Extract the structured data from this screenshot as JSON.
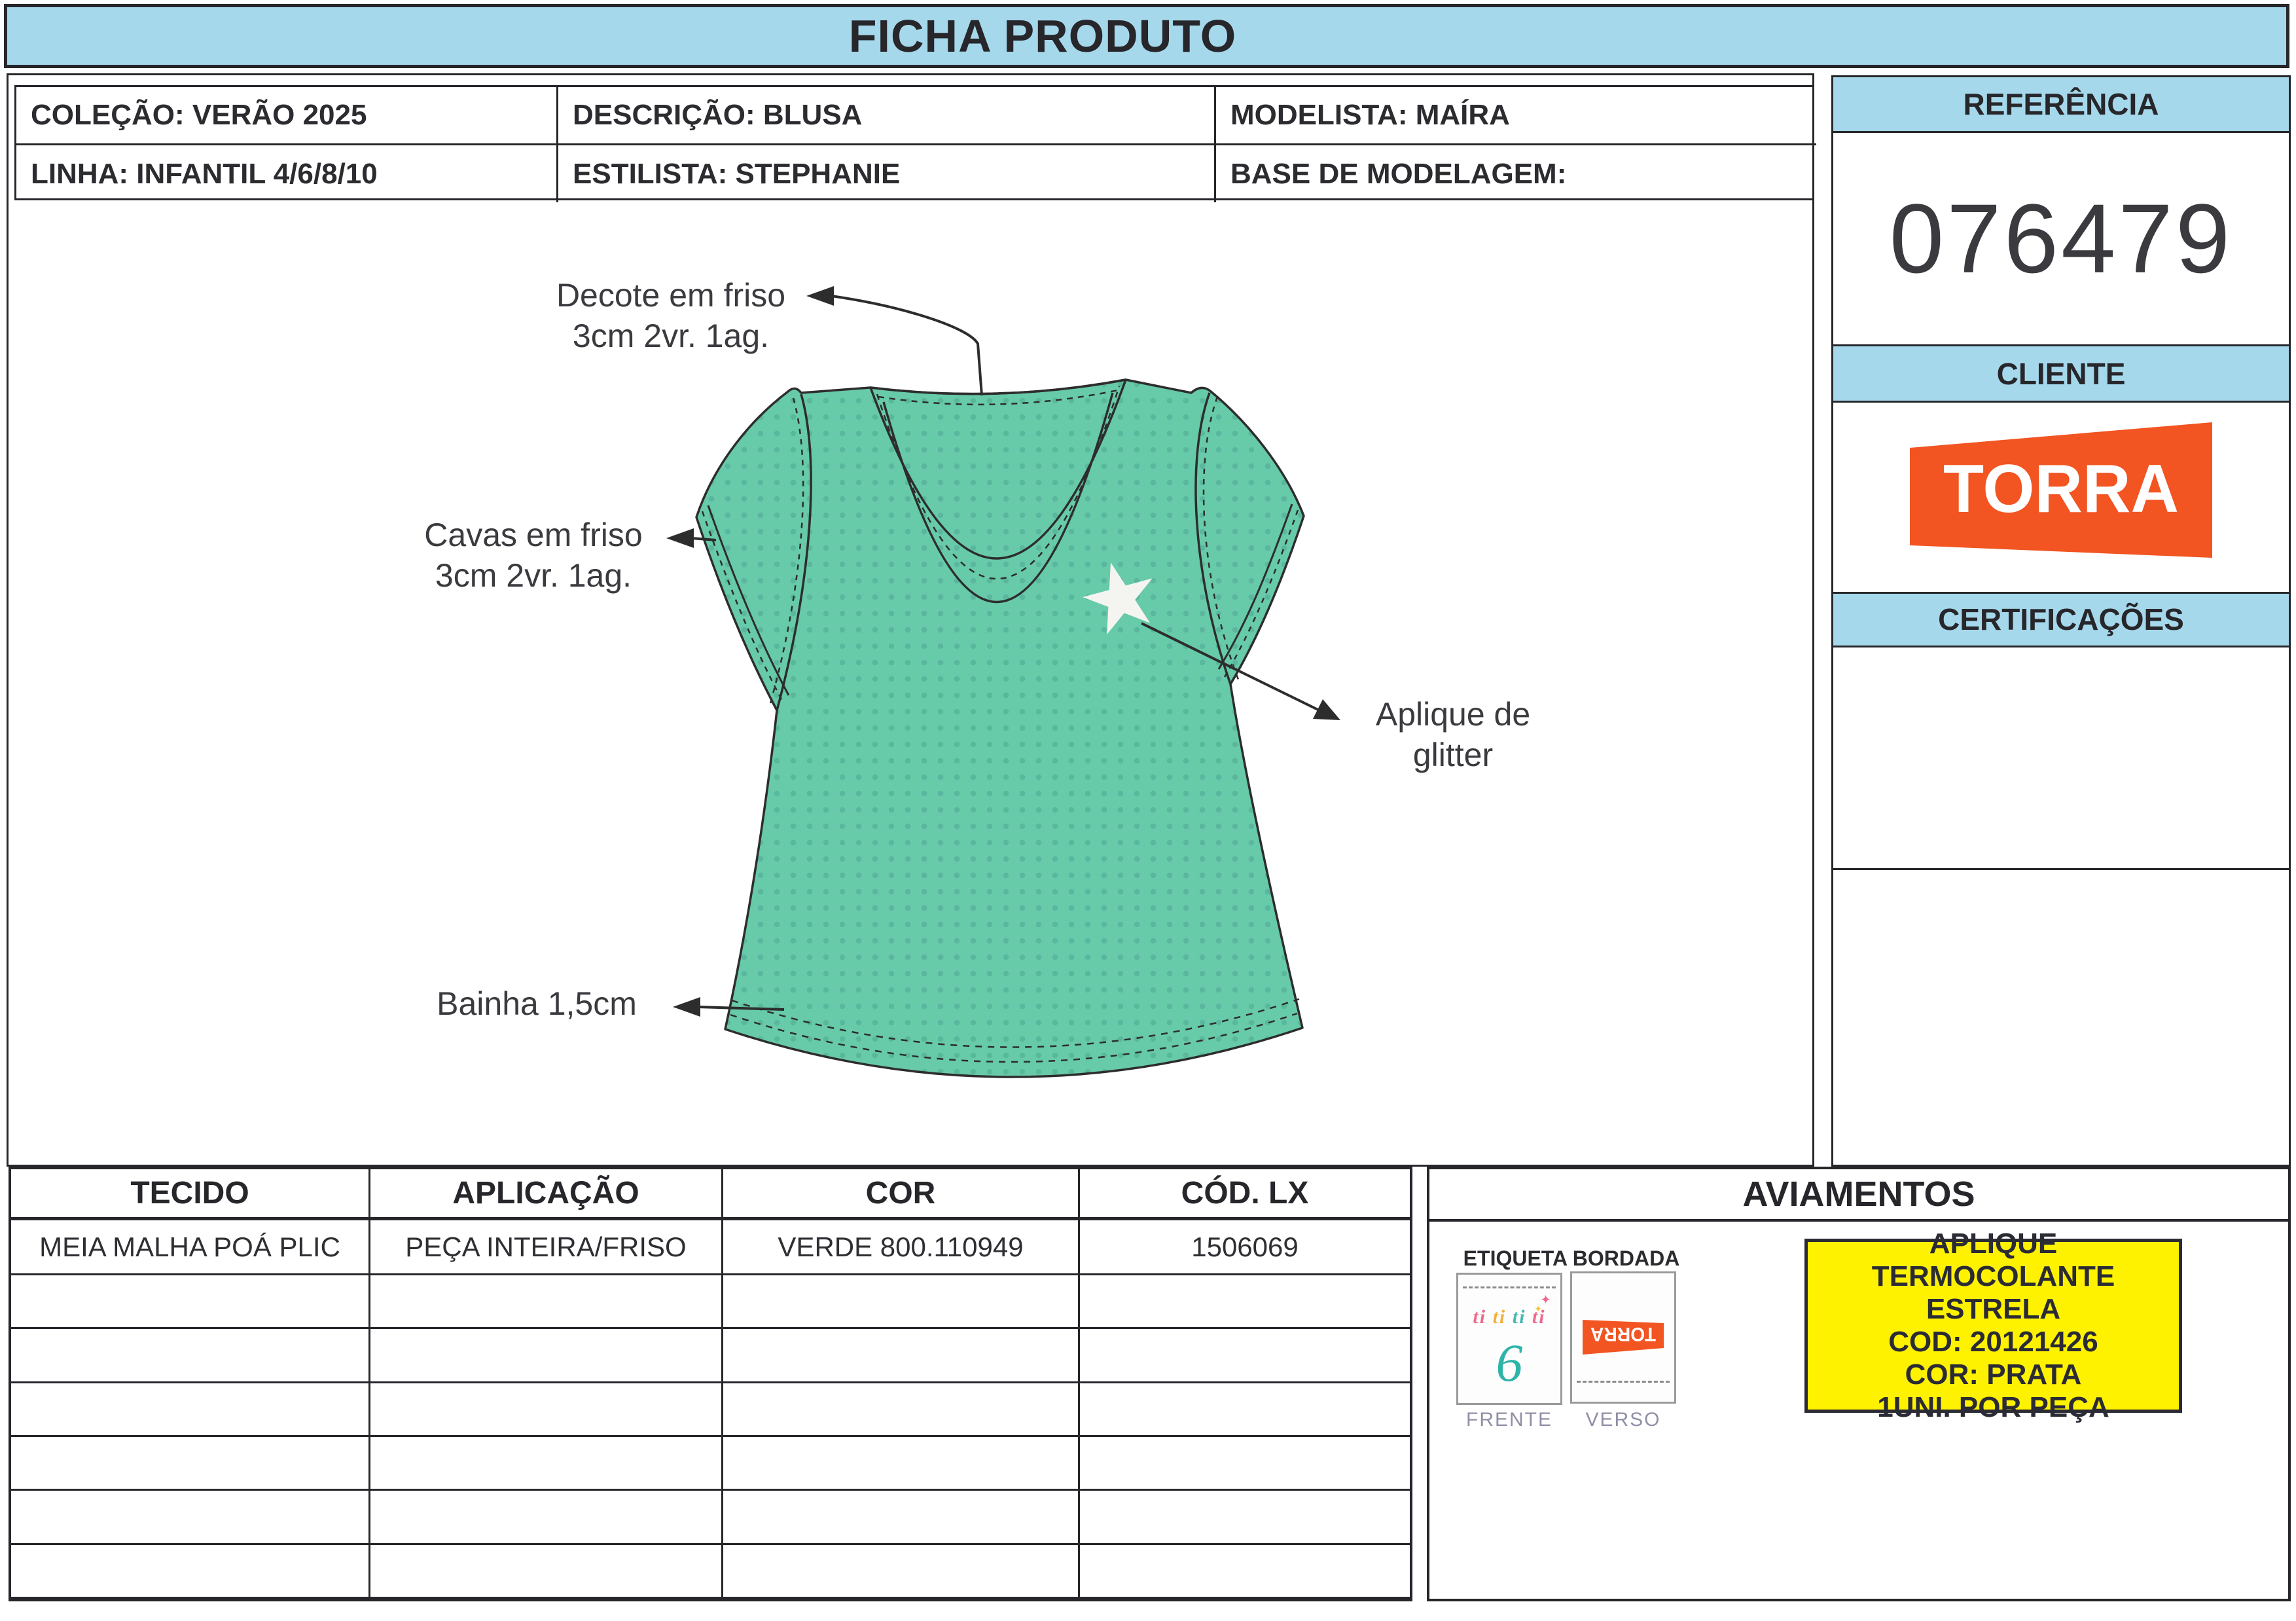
{
  "title": "FICHA PRODUTO",
  "info": {
    "colecao": "COLEÇÃO: VERÃO 2025",
    "descricao": "DESCRIÇÃO: BLUSA",
    "modelista": "MODELISTA: MAÍRA",
    "linha": "LINHA: INFANTIL 4/6/8/10",
    "estilista": "ESTILISTA: STEPHANIE",
    "base_modelagem": "BASE DE MODELAGEM:"
  },
  "sidebar": {
    "referencia_label": "REFERÊNCIA",
    "referencia_value": "076479",
    "cliente_label": "CLIENTE",
    "cliente_logo_text": "TORRA",
    "certificacoes_label": "CERTIFICAÇÕES"
  },
  "annotations": {
    "decote_line1": "Decote em friso",
    "decote_line2": "3cm 2vr. 1ag.",
    "cavas_line1": "Cavas em friso",
    "cavas_line2": "3cm 2vr. 1ag.",
    "bainha": "Bainha 1,5cm",
    "aplique_line1": "Aplique de",
    "aplique_line2": "glitter"
  },
  "table": {
    "headers": [
      "TECIDO",
      "APLICAÇÃO",
      "COR",
      "CÓD. LX"
    ],
    "rows": [
      [
        "MEIA MALHA POÁ PLIC",
        "PEÇA INTEIRA/FRISO",
        "VERDE 800.110949",
        "1506069"
      ],
      [
        "",
        "",
        "",
        ""
      ],
      [
        "",
        "",
        "",
        ""
      ],
      [
        "",
        "",
        "",
        ""
      ],
      [
        "",
        "",
        "",
        ""
      ],
      [
        "",
        "",
        "",
        ""
      ],
      [
        "",
        "",
        "",
        ""
      ]
    ]
  },
  "aviamentos": {
    "title": "AVIAMENTOS",
    "etiqueta_label": "ETIQUETA BORDADA",
    "tag_brand": [
      "ti",
      "ti",
      "ti",
      "ti"
    ],
    "tag_number": "6",
    "tag_logo_text": "TORRA",
    "frente_caption": "FRENTE",
    "verso_caption": "VERSO",
    "yellow_note_lines": [
      "APLIQUE TERMOCOLANTE",
      "ESTRELA",
      "COD: 20121426",
      "COR: PRATA",
      "1UNI. POR PEÇA"
    ]
  },
  "colors": {
    "header_blue": "#a6d8eb",
    "torra_orange": "#f25422",
    "note_yellow": "#fff200",
    "garment_green": "#67caa9",
    "garment_dot_green": "#55b09a",
    "border_dark": "#26262b"
  }
}
